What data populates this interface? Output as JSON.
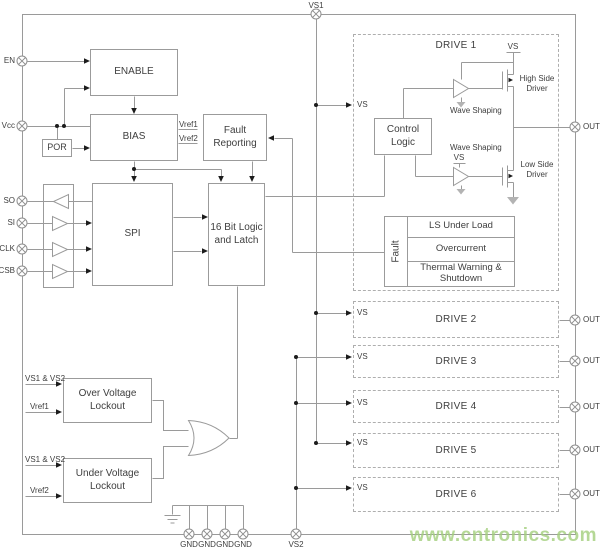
{
  "watermark": {
    "text": "www.cntronics.com",
    "color": "#a3cf7d"
  },
  "signals": {
    "vs": "VS",
    "vref1": "Vref1",
    "vref2": "Vref2",
    "vs1_and_vs2": "VS1 & VS2",
    "wave_shaping": "Wave Shaping",
    "high_side_driver": "High Side Driver",
    "low_side_driver": "Low Side Driver"
  },
  "pins": {
    "top": [
      {
        "label": "VS1"
      }
    ],
    "left": [
      {
        "label": "EN"
      },
      {
        "label": "Vcc"
      },
      {
        "label": "SO"
      },
      {
        "label": "SI"
      },
      {
        "label": "SCLK"
      },
      {
        "label": "CSB"
      }
    ],
    "right": [
      {
        "label": "OUT1"
      },
      {
        "label": "OUT2"
      },
      {
        "label": "OUT3"
      },
      {
        "label": "OUT4"
      },
      {
        "label": "OUT5"
      },
      {
        "label": "OUT6"
      }
    ],
    "bottom": [
      {
        "label": "GND"
      },
      {
        "label": "GND"
      },
      {
        "label": "GND"
      },
      {
        "label": "GND"
      },
      {
        "label": "VS2"
      }
    ]
  },
  "blocks": {
    "enable": {
      "label": "ENABLE"
    },
    "bias": {
      "label": "BIAS"
    },
    "por": {
      "label": "POR"
    },
    "spi": {
      "label": "SPI"
    },
    "logic": {
      "label": "16 Bit Logic and Latch"
    },
    "fault_reporting": {
      "label": "Fault Reporting"
    },
    "over_voltage_lockout": {
      "label": "Over Voltage Lockout"
    },
    "under_voltage_lockout": {
      "label": "Under Voltage Lockout"
    }
  },
  "drive1": {
    "title": "DRIVE 1",
    "control_logic": "Control Logic",
    "fault": {
      "label": "Fault",
      "rows": [
        "LS Under Load",
        "Overcurrent",
        "Thermal Warning & Shutdown"
      ]
    }
  },
  "drives": [
    {
      "label": "DRIVE 2"
    },
    {
      "label": "DRIVE 3"
    },
    {
      "label": "DRIVE 4"
    },
    {
      "label": "DRIVE 5"
    },
    {
      "label": "DRIVE 6"
    }
  ]
}
